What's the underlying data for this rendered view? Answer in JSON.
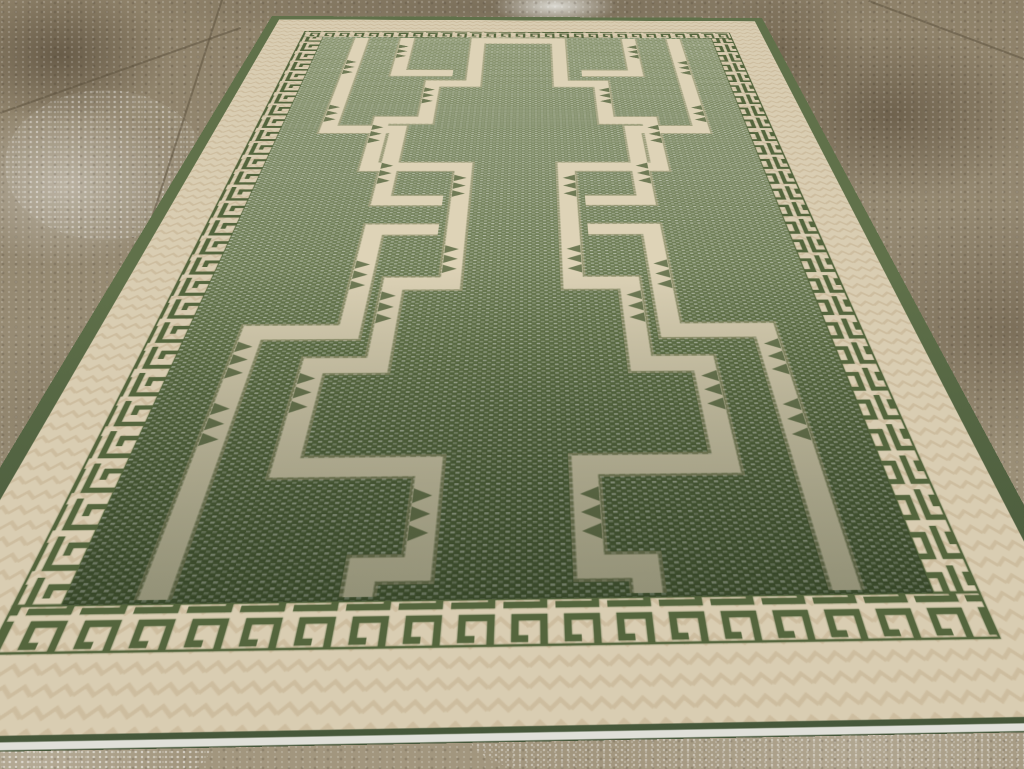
{
  "scene": {
    "description": "A green and cream room-size geometric Tulu carpet with Greek-key meander borders and interlocking stepped cross and bracket motifs, photographed in perspective lying on a stained tan concrete floor",
    "subject": "green geometric area rug",
    "setting": "stained concrete pavement with grout lines, water stains and white speckles",
    "rug": {
      "field_motifs": "interlocking stepped crosses and hook brackets in cream with small green triangle serrations",
      "guard_border": "Greek key meander, dark green on cream",
      "outer_border": "cream band with herringbone weave texture",
      "edge": "dark green band with white selvage cord at the bottom",
      "field_texture": "sage green weave with white dotted grid, darker toward the lower end"
    }
  },
  "colors": {
    "floor-base": "#978c74",
    "floor-dark": "#6e5f49",
    "floor-light": "#b0a68f",
    "grout": "#5f5440",
    "green-edge": "#60714a",
    "green-edge-dark": "#46573a",
    "green-field-light": "#8d9872",
    "green-field-mid": "#7e8b65",
    "green-field-deep": "#637449",
    "green-field-dark": "#4d5e3a",
    "green-key": "#54653d",
    "cream-border": "#d9cdb2",
    "beige-dark": "#c2ae8c",
    "cream-motif": "#ded3b7",
    "beige-halo": "#c8b795",
    "selvage": "#e9e8e2"
  }
}
